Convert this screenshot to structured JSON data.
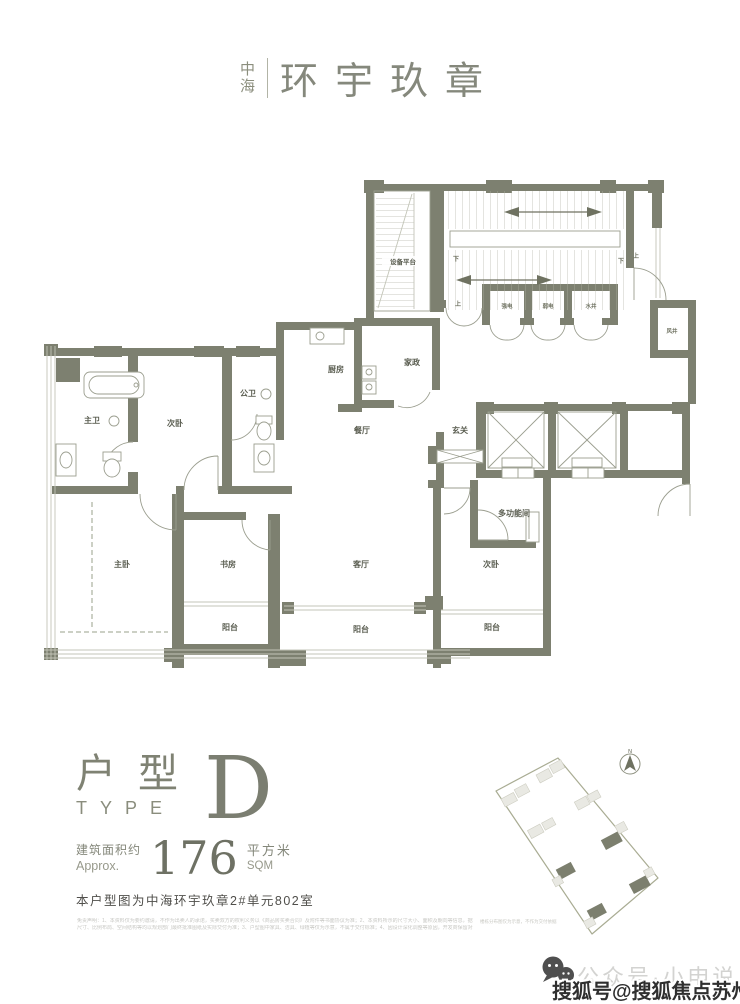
{
  "brand": {
    "mark_top": "中",
    "mark_bottom": "海",
    "name": "环宇玖章"
  },
  "floorplan": {
    "labels": {
      "equipment": "设备平台",
      "up": "上",
      "down": "下",
      "strong_elec": "强电",
      "weak_elec": "弱电",
      "water_shaft": "水井",
      "air_shaft": "风井",
      "master_bath": "主卫",
      "bedroom2": "次卧",
      "public_bath": "公卫",
      "kitchen": "厨房",
      "housekeeping": "家政",
      "dining": "餐厅",
      "foyer": "玄关",
      "multi": "多功能间",
      "bedroom3": "次卧",
      "master": "主卧",
      "study": "书房",
      "living": "客厅",
      "balcony1": "阳台",
      "balcony2": "阳台",
      "balcony3": "阳台"
    }
  },
  "unit": {
    "type_cn": "户型",
    "type_en": "TYPE",
    "type_letter": "D",
    "area_label_cn": "建筑面积约",
    "area_label_en": "Approx.",
    "area_value": "176",
    "area_unit_cn": "平方米",
    "area_unit_en": "SQM",
    "description": "本户型图为中海环宇玖章2#单元802室"
  },
  "disclaimer": {
    "line1": "免责声明：1、本资料仅为要约邀请，不作为出卖人的承诺，买卖双方的权利义务以《商品房买卖合同》及附件等书面协议为准；2、本资料所示的尺寸大小、面积及朝向等信息，据现行有效的勘察设计文件编制，不作为出卖人之最终承诺，最终平面布局及尺寸以政府部门最终批准的图纸和实际交付为准；",
    "line2": "尺寸、比例布局、空间结构等均以规划部门最终批准图纸及实际交付为准；3、户型图中家具、洁具、绿植等仅为示意，不属于交付标准；4、因设计深化调整等原因，开发商保留对本资料进行修改的权利，敬请留意最新资料；本资料制作于2023年，请以最新公示信息为准。"
  },
  "sitemap": {
    "north": "N",
    "note": "楼栋分布图仅为示意，不作为交付依据"
  },
  "watermark": {
    "wechat_text": "公众号·小申说",
    "sohu_text": "搜狐号@搜狐焦点苏州站"
  }
}
